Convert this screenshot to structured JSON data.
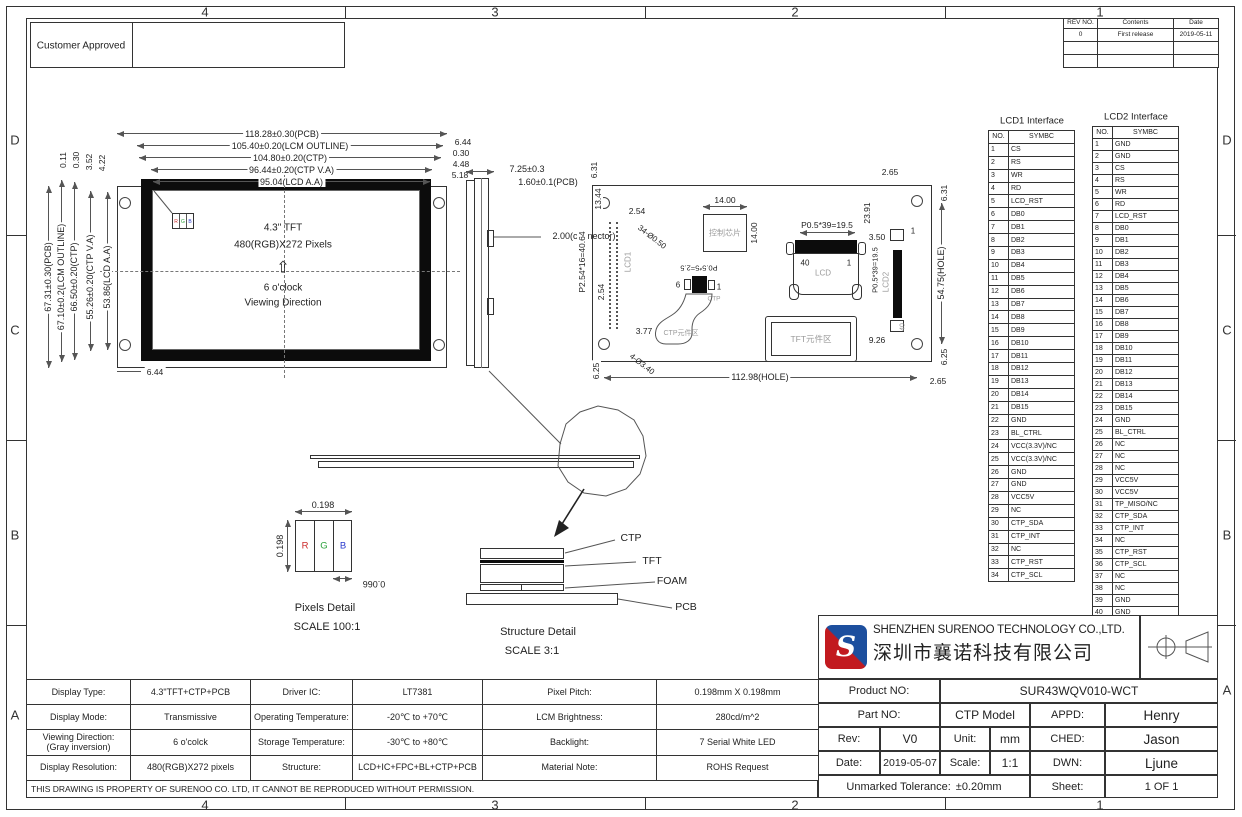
{
  "frame": {
    "zones_h": [
      "4",
      "3",
      "2",
      "1"
    ],
    "zones_v": [
      "D",
      "C",
      "B",
      "A"
    ]
  },
  "stamp": {
    "customer_approved": "Customer Approved"
  },
  "revision_table": {
    "headers": [
      "REV NO.",
      "Contents",
      "Date"
    ],
    "rows": [
      [
        "0",
        "First release",
        "2019-05-11"
      ],
      [
        "",
        "",
        ""
      ],
      [
        "",
        "",
        ""
      ]
    ]
  },
  "front_view": {
    "dims_top": [
      "118.28±0.30(PCB)",
      "105.40±0.20(LCM  OUTLINE)",
      "104.80±0.20(CTP)",
      "96.44±0.20(CTP  V.A)",
      "95.04(LCD  A.A)"
    ],
    "dims_left": [
      "67.31±0.30(PCB)",
      "67.10±0.2(LCM  OUTLINE)",
      "66.50±0.20(CTP)",
      "55.26±0.20(CTP  V.A)",
      "53.86(LCD  A.A)"
    ],
    "dims_left_small": [
      "0.11",
      "0.30",
      "3.52",
      "4.22"
    ],
    "dims_right_small": [
      "6.44",
      "0.30",
      "4.48",
      "5.18"
    ],
    "dim_bottom": "6.44",
    "rgb_letters": [
      "R",
      "G",
      "B"
    ],
    "center_line1": "4.3\" TFT",
    "center_line2": "480(RGB)X272 Pixels",
    "arrow_glyph": "⇧",
    "viewing_line1": "6 o'clock",
    "viewing_line2": "Viewing Direction"
  },
  "side_view": {
    "dim1": "7.25±0.3",
    "dim2": "1.60±0.1(PCB)",
    "dim3": "2.00(connector)"
  },
  "back_view": {
    "dim_6_31_left": "6.31",
    "dim_13_44": "13.44",
    "dim_2_54_a": "2.54",
    "dim_2_54_b": "2.54",
    "dim_p254": "P2.54*16=40.64",
    "dim_3_77": "3.77",
    "dim_6_25_left": "6.25",
    "note_holes_small": "34-Ø0.50",
    "note_holes_big": "4-Ø3.40",
    "lcd1_label": "LCD1",
    "chip_label": "控制芯片",
    "dim_14_h": "14.00",
    "dim_14_v": "14.00",
    "lcd_conn_pitch": "P0.5*39=19.5",
    "lcd_pin40": "40",
    "lcd_pin1": "1",
    "lcd_label": "LCD",
    "dim_23_91": "23.91",
    "dim_3_50": "3.50",
    "lcd2_pitch": "P0.5*39=19.5",
    "lcd2_label": "LCD2",
    "lcd2_pin1": "1",
    "lcd2_pin40": "40",
    "dim_9_26": "9.26",
    "tft_area_label": "TFT元件区",
    "ctp_pitch": "P0.5*5=2.5",
    "ctp_pin6": "6",
    "ctp_pin1": "1",
    "ctp_label": "CTP",
    "ctp_area_label": "CTP元件区",
    "dim_2_65_top": "2.65",
    "dim_2_65_bottom": "2.65",
    "dim_6_31_right": "6.31",
    "dim_6_25_right": "6.25",
    "dim_hole_v": "54.75(HOLE)",
    "dim_hole_h": "112.98(HOLE)"
  },
  "pixels_detail": {
    "dim_w": "0.198",
    "dim_h": "0.198",
    "dim_sub": "0.066",
    "letters": [
      "R",
      "G",
      "B"
    ],
    "title": "Pixels Detail",
    "scale": "SCALE 100:1"
  },
  "structure_detail": {
    "layers": [
      "CTP",
      "TFT",
      "FOAM",
      "PCB"
    ],
    "title": "Structure Detail",
    "scale": "SCALE 3:1"
  },
  "lcd1_interface": {
    "title": "LCD1 Interface",
    "headers": [
      "NO.",
      "SYMBC"
    ],
    "rows": [
      [
        "1",
        "CS"
      ],
      [
        "2",
        "RS"
      ],
      [
        "3",
        "WR"
      ],
      [
        "4",
        "RD"
      ],
      [
        "5",
        "LCD_RST"
      ],
      [
        "6",
        "DB0"
      ],
      [
        "7",
        "DB1"
      ],
      [
        "8",
        "DB2"
      ],
      [
        "9",
        "DB3"
      ],
      [
        "10",
        "DB4"
      ],
      [
        "11",
        "DB5"
      ],
      [
        "12",
        "DB6"
      ],
      [
        "13",
        "DB7"
      ],
      [
        "14",
        "DB8"
      ],
      [
        "15",
        "DB9"
      ],
      [
        "16",
        "DB10"
      ],
      [
        "17",
        "DB11"
      ],
      [
        "18",
        "DB12"
      ],
      [
        "19",
        "DB13"
      ],
      [
        "20",
        "DB14"
      ],
      [
        "21",
        "DB15"
      ],
      [
        "22",
        "GND"
      ],
      [
        "23",
        "BL_CTRL"
      ],
      [
        "24",
        "VCC(3.3V)/NC"
      ],
      [
        "25",
        "VCC(3.3V)/NC"
      ],
      [
        "26",
        "GND"
      ],
      [
        "27",
        "GND"
      ],
      [
        "28",
        "VCC5V"
      ],
      [
        "29",
        "NC"
      ],
      [
        "30",
        "CTP_SDA"
      ],
      [
        "31",
        "CTP_INT"
      ],
      [
        "32",
        "NC"
      ],
      [
        "33",
        "CTP_RST"
      ],
      [
        "34",
        "CTP_SCL"
      ]
    ]
  },
  "lcd2_interface": {
    "title": "LCD2 Interface",
    "headers": [
      "NO.",
      "SYMBC"
    ],
    "rows": [
      [
        "1",
        "GND"
      ],
      [
        "2",
        "GND"
      ],
      [
        "3",
        "CS"
      ],
      [
        "4",
        "RS"
      ],
      [
        "5",
        "WR"
      ],
      [
        "6",
        "RD"
      ],
      [
        "7",
        "LCD_RST"
      ],
      [
        "8",
        "DB0"
      ],
      [
        "9",
        "DB1"
      ],
      [
        "10",
        "DB2"
      ],
      [
        "11",
        "DB3"
      ],
      [
        "12",
        "DB4"
      ],
      [
        "13",
        "DB5"
      ],
      [
        "14",
        "DB6"
      ],
      [
        "15",
        "DB7"
      ],
      [
        "16",
        "DB8"
      ],
      [
        "17",
        "DB9"
      ],
      [
        "18",
        "DB10"
      ],
      [
        "19",
        "DB11"
      ],
      [
        "20",
        "DB12"
      ],
      [
        "21",
        "DB13"
      ],
      [
        "22",
        "DB14"
      ],
      [
        "23",
        "DB15"
      ],
      [
        "24",
        "GND"
      ],
      [
        "25",
        "BL_CTRL"
      ],
      [
        "26",
        "NC"
      ],
      [
        "27",
        "NC"
      ],
      [
        "28",
        "NC"
      ],
      [
        "29",
        "VCC5V"
      ],
      [
        "30",
        "VCC5V"
      ],
      [
        "31",
        "TP_MISO/NC"
      ],
      [
        "32",
        "CTP_SDA"
      ],
      [
        "33",
        "CTP_INT"
      ],
      [
        "34",
        "NC"
      ],
      [
        "35",
        "CTP_RST"
      ],
      [
        "36",
        "CTP_SCL"
      ],
      [
        "37",
        "NC"
      ],
      [
        "38",
        "NC"
      ],
      [
        "39",
        "GND"
      ],
      [
        "40",
        "GND"
      ]
    ]
  },
  "spec_table": {
    "rows": [
      [
        "Display Type:",
        "4.3\"TFT+CTP+PCB",
        "Driver IC:",
        "LT7381",
        "Pixel Pitch:",
        "0.198mm X 0.198mm"
      ],
      [
        "Display Mode:",
        "Transmissive",
        "Operating Temperature:",
        "-20℃ to +70℃",
        "LCM Brightness:",
        "280cd/m^2"
      ],
      [
        "Viewing Direction:\n(Gray inversion)",
        "6 o'colck",
        "Storage Temperature:",
        "-30℃ to +80℃",
        "Backlight:",
        "7 Serial White LED"
      ],
      [
        "Display Resolution:",
        "480(RGB)X272 pixels",
        "Structure:",
        "LCD+IC+FPC+BL+CTP+PCB",
        "Material Note:",
        "ROHS Request"
      ]
    ]
  },
  "title_block": {
    "company_en": "SHENZHEN SURENOO TECHNOLOGY CO.,LTD.",
    "company_cn": "深圳市襄诺科技有限公司",
    "product_no_label": "Product NO:",
    "product_no": "SUR43WQV010-WCT",
    "part_no_label": "Part NO:",
    "part_no": "CTP Model",
    "appd_label": "APPD:",
    "appd": "Henry",
    "rev_label": "Rev:",
    "rev": "V0",
    "unit_label": "Unit:",
    "unit": "mm",
    "ched_label": "CHED:",
    "ched": "Jason",
    "date_label": "Date:",
    "date": "2019-05-07",
    "scale_label": "Scale:",
    "scale": "1:1",
    "dwn_label": "DWN:",
    "dwn": "Ljune",
    "tolerance_label": "Unmarked Tolerance:",
    "tolerance_value": "±0.20mm",
    "sheet_label": "Sheet:",
    "sheet": "1 OF 1"
  },
  "disclaimer": "THIS DRAWING IS PROPERTY OF SURENOO CO. LTD, IT CANNOT BE REPRODUCED WITHOUT PERMISSION.",
  "colors": {
    "subpixel_red": "#cc2a2a",
    "subpixel_green": "#2aa03a",
    "subpixel_blue": "#2a3acc",
    "logo_blue": "#1d4f9e",
    "logo_red": "#c21a1f",
    "line": "#555555",
    "ghost_text": "#9a9a9a"
  }
}
